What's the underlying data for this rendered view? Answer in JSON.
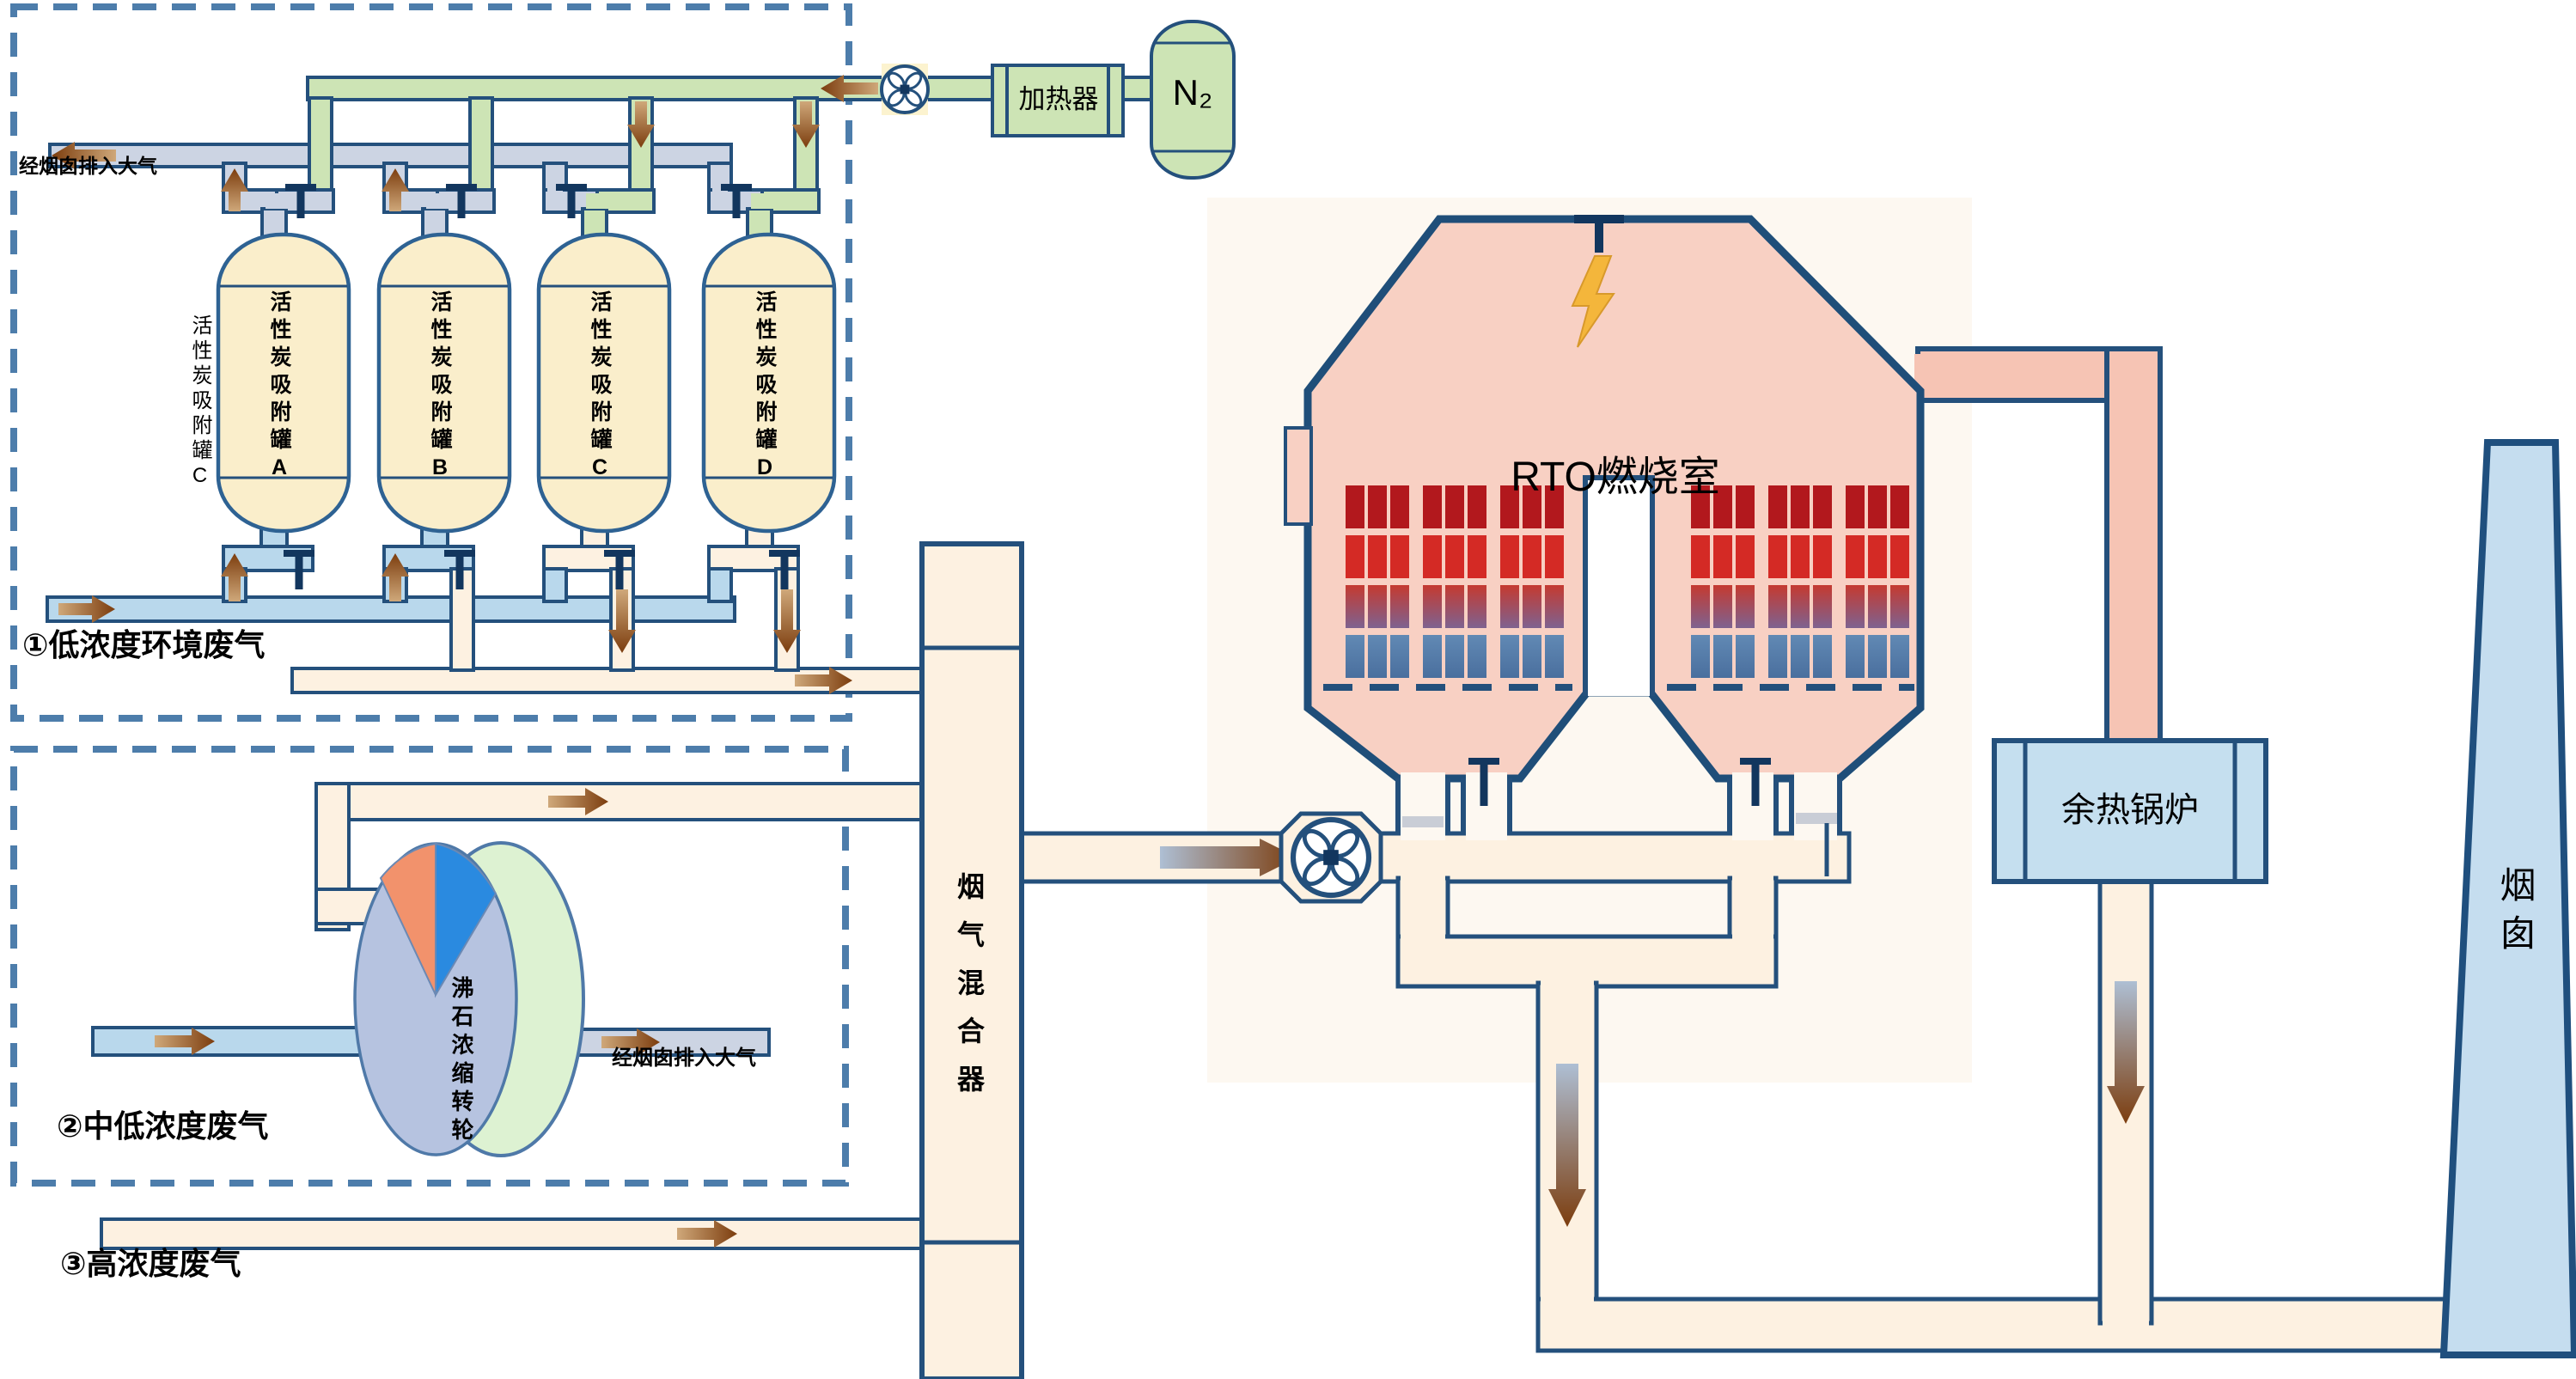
{
  "labels": {
    "box1_stream": "①低浓度环境废气",
    "box1_to_atmosphere": "经烟囱排入大气",
    "box1_side_tank": "活性炭吸附罐C",
    "box2_stream": "②中低浓度废气",
    "box2_wheel": "沸石浓缩转轮",
    "box2_to_atmosphere": "经烟囱排入大气",
    "high_stream": "③高浓度废气",
    "heater": "加热器",
    "nitrogen": "N₂",
    "mixer": "烟气混合器",
    "rto": "RTO燃烧室",
    "boiler": "余热锅炉",
    "stack": "烟囱"
  },
  "tanks": [
    {
      "label": "活性炭吸附罐A"
    },
    {
      "label": "活性炭吸附罐B"
    },
    {
      "label": "活性炭吸附罐C"
    },
    {
      "label": "活性炭吸附罐D"
    }
  ],
  "colors": {
    "pipe_border_navy": "#24507c",
    "n2_pipe_green": "#cde4b5",
    "exhaust_pipe_gray": "#ccd4e3",
    "wastegas_pipe_blue": "#b9d8ec",
    "desorption_pipe_cream": "#fdf1e1",
    "rto_pink": "#f8d0c3",
    "rto_outlet_pink": "#f6c4b4",
    "tank_fill_yellow": "#faeecb",
    "boiler_stack_blue": "#c5ddef",
    "dashed_border_blue": "#4d7dab",
    "flow_arrow_brown": "#7c3d0e",
    "bed_row_dark_red": "#b2181d",
    "bed_row_red": "#d42a25",
    "bed_row_blue": "#5480ad",
    "wheel_front_blue": "#b6c3e0",
    "wheel_rim_green": "#ddf2d2",
    "wheel_wedge_orange": "#f2926c",
    "wheel_wedge_blue": "#2a8ae0",
    "lightning_gold": "#f4b63b",
    "valve_navy": "#12365e"
  },
  "icons": [
    "fan-icon",
    "valve-icon",
    "lightning-icon",
    "flow-arrow-icon",
    "burner-icon"
  ]
}
